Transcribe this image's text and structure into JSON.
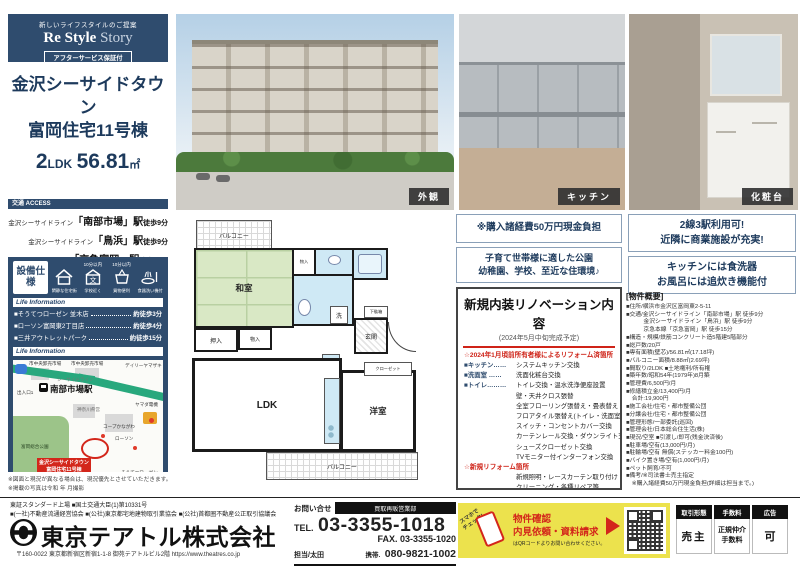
{
  "brand": {
    "tagline": "新しいライフスタイルのご提案",
    "name1": "Re Style",
    "name2": "Story",
    "badge": "アフターサービス保証付"
  },
  "property": {
    "name1": "金沢シーサイドタウン",
    "name2": "富岡住宅11号棟",
    "layout_num": "2",
    "layout_txt": "LDK",
    "area_num": "56.81",
    "area_unit": "㎡"
  },
  "access": {
    "header": "交通 ACCESS",
    "routes": [
      {
        "line": "金沢シーサイドライン",
        "station": "「南部市場」駅",
        "walk": "徒歩9分"
      },
      {
        "line": "金沢シーサイドライン",
        "station": "「鳥浜」駅",
        "walk": "徒歩9分"
      },
      {
        "line": "京急本線",
        "station": "「京急富岡」駅",
        "walk": "徒歩15分"
      }
    ]
  },
  "equipment": {
    "label": "設備仕様",
    "items": [
      {
        "top": "",
        "caption": "閑静な住宅街"
      },
      {
        "top": "10分以内",
        "caption": "学校近く"
      },
      {
        "top": "10分以内",
        "caption": "買物便利"
      },
      {
        "top": "",
        "caption": "食器洗い機付"
      }
    ]
  },
  "life_info": {
    "header": "Life Information",
    "stores": [
      {
        "name": "■そうてつローゼン 並木店",
        "walk": "約徒歩3分"
      },
      {
        "name": "■ローソン富岡東2丁目店",
        "walk": "約徒歩4分"
      },
      {
        "name": "■三井アウトレットパーク",
        "walk": "約徒歩15分"
      }
    ]
  },
  "map": {
    "header": "Life Information",
    "labels": [
      "市中央卸売市場",
      "市中央卸売市場",
      "シーサイドライン",
      "出入口1",
      "南部市場駅",
      "デイリーヤマザキ",
      "ヤマダ電機",
      "神奈川県営",
      "コープかながわ",
      "ローソン",
      "富岡総合公園",
      "そうてつローゼン"
    ],
    "marker1": "金沢シーサイドタウン",
    "marker2": "富岡住宅11号棟"
  },
  "notes": {
    "line1": "※図面と現況が異なる場合は、現況優先とさせていただきます。",
    "line2": "※掲載の写真は令和 年 月撮影"
  },
  "photos": {
    "exterior": "外観",
    "kitchen": "キッチン",
    "vanity": "化粧台"
  },
  "floorplan": {
    "balcony_top": "バルコニー",
    "washitsu": "和室",
    "mono1": "物入",
    "oshiire": "押入",
    "mono2": "物入",
    "sen": "洗",
    "getabako": "下駄箱",
    "genkan": "玄関",
    "closet": "クローゼット",
    "rei": "冷",
    "ldk": "LDK",
    "yoshitsu": "洋室",
    "balcony_bottom": "バルコニー"
  },
  "highlights": {
    "left1": "※購入諸経費50万円現金負担",
    "left2a": "子育て世帯様に適した公園",
    "left2b": "幼稚園、学校、至近な住環境♪",
    "right1a": "2線3駅利用可!",
    "right1b": "近隣に商業施設が充実!",
    "right2a": "キッチンには食洗器",
    "right2b": "お風呂には追炊き機能付"
  },
  "renovation": {
    "title": "新規内装リノベーション内容",
    "subtitle": "(2024年5月中旬完成予定)",
    "section1": "☆2024年1月頃前所有者様によるリフォーム済箇所",
    "items1": [
      {
        "l": "■キッチン……",
        "t": "システムキッチン交換"
      },
      {
        "l": "■洗面室 ……",
        "t": "洗面化粧台交換"
      },
      {
        "l": "■トイレ………",
        "t": "トイレ交換・温水洗浄便座設置"
      },
      {
        "l": "",
        "t": "壁・天井クロス張替"
      },
      {
        "l": "",
        "t": "全室フローリング張替え・畳表替え"
      },
      {
        "l": "",
        "t": "フロアタイル張替え(トイレ・洗面室)"
      },
      {
        "l": "",
        "t": "スイッチ・コンセントカバー交換"
      },
      {
        "l": "",
        "t": "カーテンレール交換・ダウンライト交換"
      },
      {
        "l": "",
        "t": "シューズクローゼット交換"
      },
      {
        "l": "",
        "t": "TVモニター付インターフォン交換"
      }
    ],
    "section2": "☆新規リフォーム箇所",
    "items2": [
      "新規照明・レースカーテン取り付け",
      "クリーニング・各種リペア等",
      "浴室水栓交換"
    ]
  },
  "outline": {
    "title": "[物件概要]",
    "lines": [
      "■住所/横浜市金沢区富岡東2-5-11",
      "■交通/金沢シーサイドライン「南部市場」駅 徒歩9分",
      "　　　金沢シーサイドライン「鳥浜」駅 徒歩9分",
      "　　　京急本線「京急富岡」駅 徒歩15分",
      "■構造・規模/鉄筋コンクリート造5階建5階部分",
      "■総戸数/20戸",
      "■専有面積(壁芯)/56.81㎡(17.18坪)",
      "■バルコニー面積/8.88㎡(2.69坪)",
      "■間取り/2LDK ■土地権利/所有権",
      "■築年数/昭和54年(1979年)8月築",
      "■管理費/6,500円/月",
      "■修繕積立金/13,400円/月",
      "　合計:19,900円",
      "■施工会社/住宅・都市整備公団",
      "■分譲会社/住宅・都市整備公団",
      "■管理形態/一部委託(巡回)",
      "■管理会社/日本総合住生活(株)",
      "■現況/空室 ■引渡し/即可(残金決済後)",
      "■駐車場/空有(13,000円/月)",
      "■駐輪場/空有 無償(ステッカー料金100円)",
      "■バイク置き場/空有(1,000円/月)",
      "■ペット飼育/不可",
      "■備考/※司法書士売主指定",
      "　※購入諸経費50万円現金負担(詳細は担当まで。)"
    ]
  },
  "footer": {
    "assoc1": "東証スタンダード上場 ■国土交通大臣(1)第10331号",
    "assoc2": "■(一社)不動産流通経営協会 ■(公社)東京都宅地建物取引業協会 ■(公社)首都圏不動産公正取引協議会",
    "company": "東京テアトル株式会社",
    "address": "〒160-0022 東京都新宿区新宿1-1-8 御苑テアトルビル2階 https://www.theatres.co.jp",
    "contact_label": "お問い合せ",
    "dept": "買取再販営業部",
    "tel_label": "TEL.",
    "tel": "03-3355-1018",
    "fax": "FAX. 03-3355-1020",
    "person": "担当/太田",
    "mobile_label": "携帯.",
    "mobile": "080-9821-1002",
    "promo": {
      "check1": "スマホで",
      "check2": "チェック!",
      "t1": "物件確認",
      "t2": "内見依頼・資料請求",
      "t3": "はQRコードよりお問い合わせください。"
    },
    "badges": [
      {
        "label": "取引形態",
        "value": "売主"
      },
      {
        "label": "手数料",
        "value": "正規仲介手数料"
      },
      {
        "label": "広告",
        "value": "可"
      }
    ]
  },
  "colors": {
    "navy": "#2f4c6e",
    "red": "#cf2318",
    "yellow": "#ece24d"
  }
}
